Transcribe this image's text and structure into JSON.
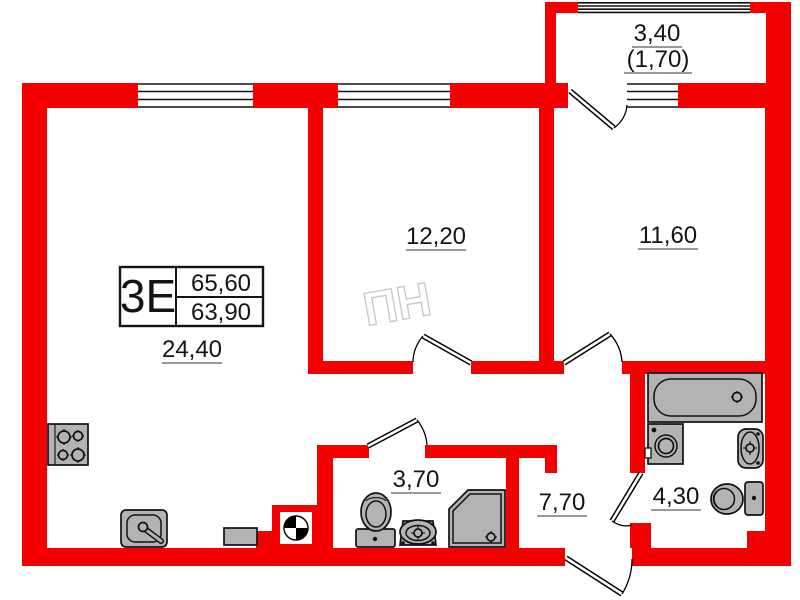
{
  "stamp": {
    "type_label": "3Е",
    "total_area": "65,60",
    "living_area": "63,90"
  },
  "rooms": {
    "living_kitchen": "24,40",
    "bedroom_1": "12,20",
    "bedroom_2": "11,60",
    "balcony_full": "3,40",
    "balcony_reduced": "(1,70)",
    "bathroom_shower": "3,70",
    "hallway": "7,70",
    "bathroom_tub": "4,30"
  },
  "watermark": "ПН",
  "colors": {
    "wall": "#f40000",
    "fixture_fill": "#b3b3b3",
    "outline": "#111111"
  }
}
